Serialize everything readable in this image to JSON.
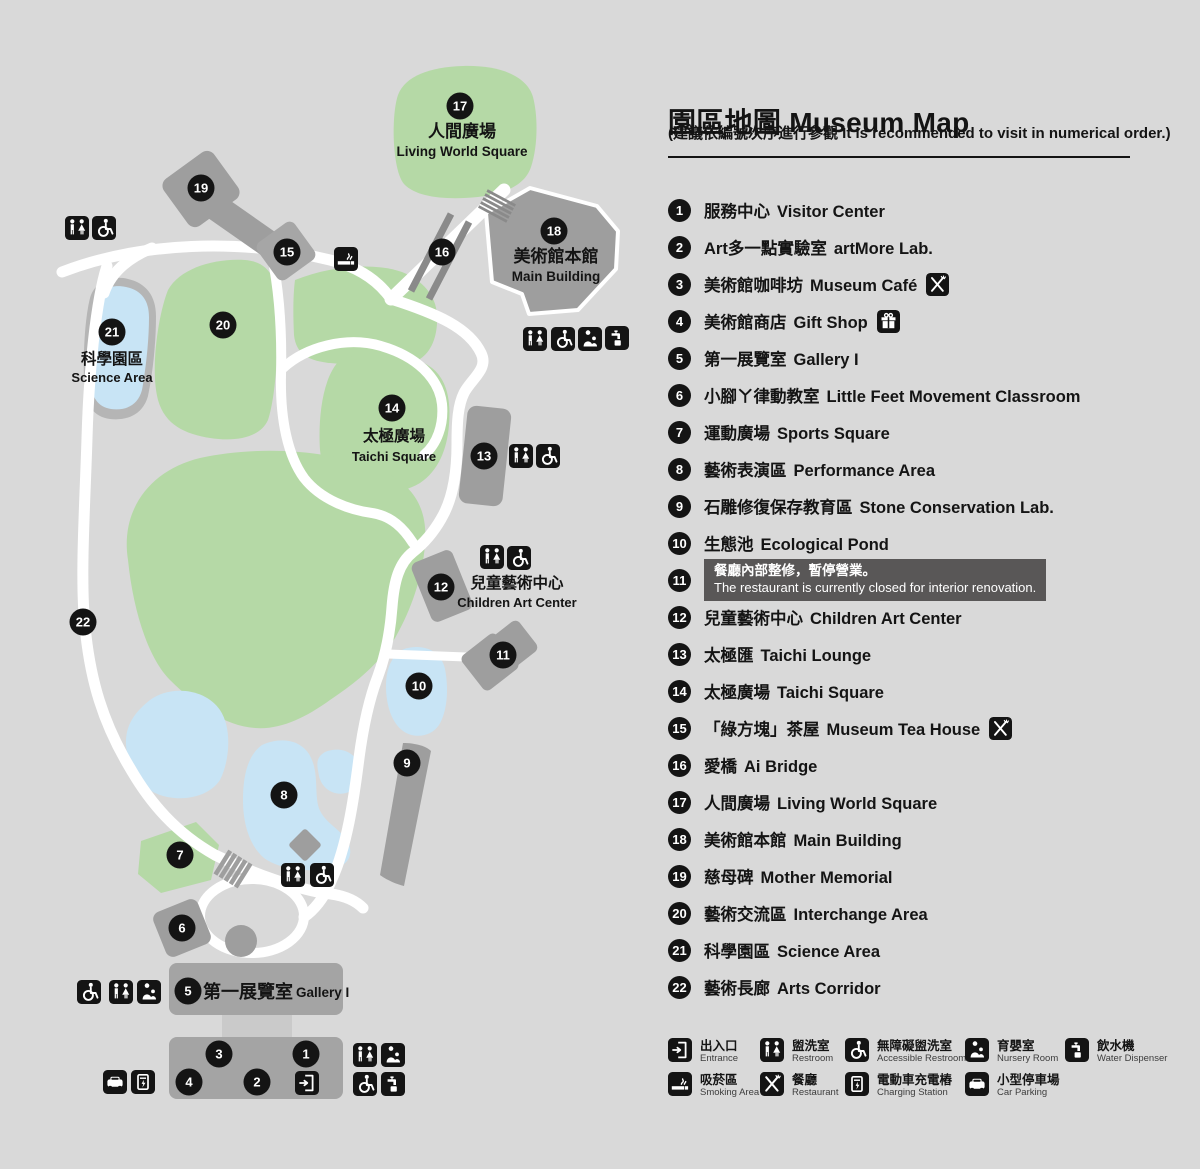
{
  "title_zh": "園區地圖",
  "title_en": "Museum Map",
  "subtitle": "(建議依編號次序進行參觀 It is recommended to visit in numerical order.)",
  "colors": {
    "background": "#d9d9d9",
    "green_area": "#b5d9a6",
    "water_blue": "#c8e4f5",
    "building_gray": "#9e9e9e",
    "road_white": "#ffffff",
    "marker_black": "#141414",
    "notice_box": "#595757"
  },
  "legend": {
    "items": [
      {
        "n": 1,
        "zh": "服務中心",
        "en": "Visitor Center"
      },
      {
        "n": 2,
        "zh": "Art多一點實驗室",
        "en": "artMore Lab."
      },
      {
        "n": 3,
        "zh": "美術館咖啡坊",
        "en": "Museum Café",
        "icon": "restaurant"
      },
      {
        "n": 4,
        "zh": "美術館商店",
        "en": "Gift Shop",
        "icon": "gift"
      },
      {
        "n": 5,
        "zh": "第一展覽室",
        "en": "Gallery I"
      },
      {
        "n": 6,
        "zh": "小腳ㄚ律動教室",
        "en": "Little Feet Movement Classroom"
      },
      {
        "n": 7,
        "zh": "運動廣場",
        "en": "Sports Square"
      },
      {
        "n": 8,
        "zh": "藝術表演區",
        "en": "Performance Area"
      },
      {
        "n": 9,
        "zh": "石雕修復保存教育區",
        "en": "Stone Conservation Lab."
      },
      {
        "n": 10,
        "zh": "生態池",
        "en": "Ecological Pond"
      },
      {
        "n": 11,
        "note_zh": "餐廳內部整修，暫停營業。",
        "note_en": "The restaurant is currently closed for interior renovation."
      },
      {
        "n": 12,
        "zh": "兒童藝術中心",
        "en": "Children Art Center"
      },
      {
        "n": 13,
        "zh": "太極匯",
        "en": "Taichi Lounge"
      },
      {
        "n": 14,
        "zh": "太極廣場",
        "en": "Taichi Square"
      },
      {
        "n": 15,
        "zh": "「綠方塊」茶屋",
        "en": "Museum Tea House",
        "icon": "restaurant"
      },
      {
        "n": 16,
        "zh": "愛橋",
        "en": "Ai Bridge"
      },
      {
        "n": 17,
        "zh": "人間廣場",
        "en": "Living World Square"
      },
      {
        "n": 18,
        "zh": "美術館本館",
        "en": "Main Building"
      },
      {
        "n": 19,
        "zh": "慈母碑",
        "en": "Mother Memorial"
      },
      {
        "n": 20,
        "zh": "藝術交流區",
        "en": "Interchange Area"
      },
      {
        "n": 21,
        "zh": "科學園區",
        "en": "Science Area"
      },
      {
        "n": 22,
        "zh": "藝術長廊",
        "en": "Arts Corridor"
      }
    ]
  },
  "facilities": [
    {
      "icon": "entrance",
      "zh": "出入口",
      "en": "Entrance"
    },
    {
      "icon": "restroom",
      "zh": "盥洗室",
      "en": "Restroom"
    },
    {
      "icon": "accessible",
      "zh": "無障礙盥洗室",
      "en": "Accessible Restroom"
    },
    {
      "icon": "nursery",
      "zh": "育嬰室",
      "en": "Nursery Room"
    },
    {
      "icon": "water",
      "zh": "飲水機",
      "en": "Water Dispenser"
    },
    {
      "icon": "smoking",
      "zh": "吸菸區",
      "en": "Smoking Area"
    },
    {
      "icon": "restaurant",
      "zh": "餐廳",
      "en": "Restaurant"
    },
    {
      "icon": "charging",
      "zh": "電動車充電樁",
      "en": "Charging Station"
    },
    {
      "icon": "parking",
      "zh": "小型停車場",
      "en": "Car Parking"
    }
  ],
  "map": {
    "markers": [
      {
        "n": 1,
        "x": 306,
        "y": 1054
      },
      {
        "n": 2,
        "x": 257,
        "y": 1082
      },
      {
        "n": 3,
        "x": 219,
        "y": 1054
      },
      {
        "n": 4,
        "x": 189,
        "y": 1082
      },
      {
        "n": 5,
        "x": 188,
        "y": 991
      },
      {
        "n": 6,
        "x": 182,
        "y": 928
      },
      {
        "n": 7,
        "x": 180,
        "y": 855
      },
      {
        "n": 8,
        "x": 284,
        "y": 795
      },
      {
        "n": 9,
        "x": 407,
        "y": 763
      },
      {
        "n": 10,
        "x": 419,
        "y": 686
      },
      {
        "n": 11,
        "x": 503,
        "y": 655
      },
      {
        "n": 12,
        "x": 441,
        "y": 587
      },
      {
        "n": 13,
        "x": 484,
        "y": 456
      },
      {
        "n": 14,
        "x": 392,
        "y": 408
      },
      {
        "n": 15,
        "x": 287,
        "y": 252
      },
      {
        "n": 16,
        "x": 442,
        "y": 252
      },
      {
        "n": 17,
        "x": 460,
        "y": 106
      },
      {
        "n": 18,
        "x": 554,
        "y": 231
      },
      {
        "n": 19,
        "x": 201,
        "y": 188
      },
      {
        "n": 20,
        "x": 223,
        "y": 325
      },
      {
        "n": 21,
        "x": 112,
        "y": 332
      },
      {
        "n": 22,
        "x": 83,
        "y": 622
      }
    ],
    "texts": [
      {
        "t": "人間廣場",
        "x": 462,
        "y": 137,
        "cls": "zh-lg"
      },
      {
        "t": "Living World Square",
        "x": 462,
        "y": 156,
        "cls": "en-md"
      },
      {
        "t": "美術館本館",
        "x": 556,
        "y": 262,
        "cls": "zh-lg"
      },
      {
        "t": "Main Building",
        "x": 556,
        "y": 281,
        "cls": "en-md"
      },
      {
        "t": "科學園區",
        "x": 112,
        "y": 364,
        "cls": "zh-md"
      },
      {
        "t": "Science Area",
        "x": 112,
        "y": 382,
        "cls": "en-sm"
      },
      {
        "t": "太極廣場",
        "x": 394,
        "y": 441,
        "cls": "zh-md"
      },
      {
        "t": "Taichi Square",
        "x": 394,
        "y": 461,
        "cls": "en-sm"
      },
      {
        "t": "兒童藝術中心",
        "x": 517,
        "y": 588,
        "cls": "zh-md"
      },
      {
        "t": "Children Art Center",
        "x": 517,
        "y": 607,
        "cls": "en-sm"
      },
      {
        "t": "第一展覽室",
        "x": 203,
        "y": 998,
        "cls": "zh-gallery"
      },
      {
        "t": "Gallery I",
        "x": 296,
        "y": 997,
        "cls": "en-gallery"
      }
    ],
    "icons": [
      {
        "t": "restroom",
        "x": 65,
        "y": 216
      },
      {
        "t": "accessible",
        "x": 92,
        "y": 216
      },
      {
        "t": "smoking",
        "x": 334,
        "y": 247
      },
      {
        "t": "restroom",
        "x": 523,
        "y": 327
      },
      {
        "t": "accessible",
        "x": 551,
        "y": 327
      },
      {
        "t": "nursery",
        "x": 578,
        "y": 327
      },
      {
        "t": "water",
        "x": 605,
        "y": 326
      },
      {
        "t": "restroom",
        "x": 509,
        "y": 444
      },
      {
        "t": "accessible",
        "x": 536,
        "y": 444
      },
      {
        "t": "restroom",
        "x": 480,
        "y": 545
      },
      {
        "t": "accessible",
        "x": 507,
        "y": 546
      },
      {
        "t": "restroom",
        "x": 281,
        "y": 863
      },
      {
        "t": "accessible",
        "x": 310,
        "y": 863
      },
      {
        "t": "accessible",
        "x": 77,
        "y": 980
      },
      {
        "t": "restroom",
        "x": 109,
        "y": 980
      },
      {
        "t": "nursery",
        "x": 137,
        "y": 980
      },
      {
        "t": "parking",
        "x": 103,
        "y": 1070
      },
      {
        "t": "charging",
        "x": 131,
        "y": 1070
      },
      {
        "t": "entrance",
        "x": 295,
        "y": 1071
      },
      {
        "t": "restroom",
        "x": 353,
        "y": 1043
      },
      {
        "t": "nursery",
        "x": 381,
        "y": 1043
      },
      {
        "t": "accessible",
        "x": 353,
        "y": 1072
      },
      {
        "t": "water",
        "x": 381,
        "y": 1072
      }
    ]
  }
}
